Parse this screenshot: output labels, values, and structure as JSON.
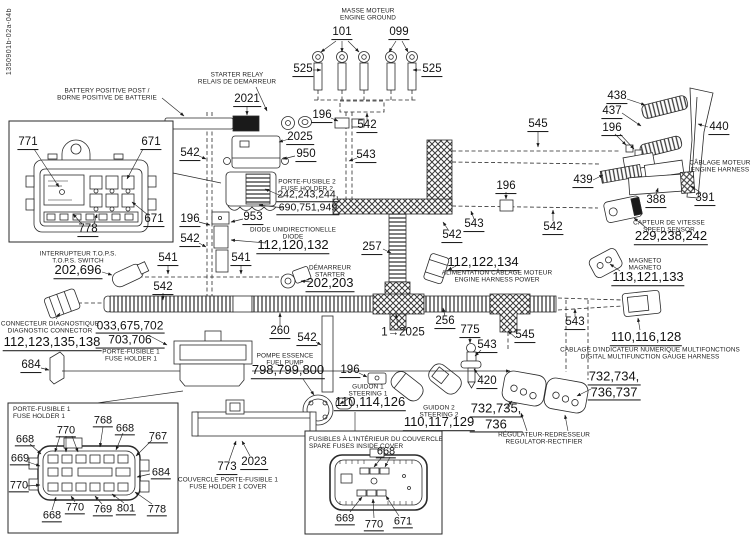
{
  "drawing_number": "1350901b-02a-04b",
  "colors": {
    "ink": "#1a1a1a",
    "paper": "#ffffff"
  },
  "callouts": [
    {
      "t": "101",
      "x": 342,
      "y": 33
    },
    {
      "t": "099",
      "x": 399,
      "y": 33
    },
    {
      "t": "525",
      "x": 303,
      "y": 70
    },
    {
      "t": "525",
      "x": 432,
      "y": 70
    },
    {
      "t": "2021",
      "x": 247,
      "y": 100
    },
    {
      "t": "196",
      "x": 322,
      "y": 116
    },
    {
      "t": "542",
      "x": 367,
      "y": 126
    },
    {
      "t": "2025",
      "x": 300,
      "y": 138
    },
    {
      "t": "950",
      "x": 306,
      "y": 155
    },
    {
      "t": "543",
      "x": 366,
      "y": 156
    },
    {
      "t": "542",
      "x": 190,
      "y": 154
    },
    {
      "t": "242,243,244,\n690,751,949",
      "x": 308,
      "y": 202,
      "s": 10.5
    },
    {
      "t": "196",
      "x": 190,
      "y": 220
    },
    {
      "t": "953",
      "x": 253,
      "y": 218
    },
    {
      "t": "112,120,132",
      "x": 293,
      "y": 246,
      "s": 13
    },
    {
      "t": "542",
      "x": 190,
      "y": 240
    },
    {
      "t": "541",
      "x": 168,
      "y": 259
    },
    {
      "t": "541",
      "x": 241,
      "y": 259
    },
    {
      "t": "542",
      "x": 163,
      "y": 288
    },
    {
      "t": "202,696",
      "x": 78,
      "y": 271,
      "s": 13
    },
    {
      "t": "112,123,135,138",
      "x": 52,
      "y": 343,
      "s": 13
    },
    {
      "t": "033,675,702\n703,706",
      "x": 130,
      "y": 334,
      "s": 12
    },
    {
      "t": "684",
      "x": 31,
      "y": 366
    },
    {
      "t": "202,203",
      "x": 330,
      "y": 284,
      "s": 13
    },
    {
      "t": "257",
      "x": 372,
      "y": 248
    },
    {
      "t": "543",
      "x": 474,
      "y": 225
    },
    {
      "t": "542",
      "x": 452,
      "y": 236
    },
    {
      "t": "112,122,134",
      "x": 483,
      "y": 263,
      "s": 13
    },
    {
      "t": "545",
      "x": 538,
      "y": 125
    },
    {
      "t": "438",
      "x": 617,
      "y": 97
    },
    {
      "t": "437",
      "x": 612,
      "y": 112
    },
    {
      "t": "196",
      "x": 612,
      "y": 129
    },
    {
      "t": "440",
      "x": 719,
      "y": 128
    },
    {
      "t": "439",
      "x": 583,
      "y": 181
    },
    {
      "t": "388",
      "x": 656,
      "y": 201
    },
    {
      "t": "391",
      "x": 705,
      "y": 199
    },
    {
      "t": "196",
      "x": 506,
      "y": 187
    },
    {
      "t": "542",
      "x": 553,
      "y": 228
    },
    {
      "t": "229,238,242",
      "x": 671,
      "y": 237,
      "s": 13
    },
    {
      "t": "113,121,133",
      "x": 648,
      "y": 278,
      "s": 13
    },
    {
      "t": "543",
      "x": 575,
      "y": 323
    },
    {
      "t": "110,116,128",
      "x": 646,
      "y": 338,
      "s": 13
    },
    {
      "t": "256",
      "x": 445,
      "y": 322
    },
    {
      "t": "1→2025",
      "x": 403,
      "y": 333,
      "u": false
    },
    {
      "t": "260",
      "x": 280,
      "y": 332
    },
    {
      "t": "542",
      "x": 307,
      "y": 339
    },
    {
      "t": "196",
      "x": 350,
      "y": 371
    },
    {
      "t": "798,799,800",
      "x": 288,
      "y": 371,
      "s": 13
    },
    {
      "t": "110,114,126",
      "x": 370,
      "y": 403,
      "s": 13
    },
    {
      "t": "775",
      "x": 470,
      "y": 331
    },
    {
      "t": "543",
      "x": 487,
      "y": 346
    },
    {
      "t": "545",
      "x": 525,
      "y": 336
    },
    {
      "t": "420",
      "x": 487,
      "y": 382
    },
    {
      "t": "110,117,129",
      "x": 439,
      "y": 423,
      "s": 13
    },
    {
      "t": "732,735,\n736",
      "x": 496,
      "y": 417,
      "s": 13
    },
    {
      "t": "732,734,\n736,737",
      "x": 614,
      "y": 385,
      "s": 13
    },
    {
      "t": "773",
      "x": 227,
      "y": 468
    },
    {
      "t": "2023",
      "x": 254,
      "y": 463
    },
    {
      "t": "771",
      "x": 28,
      "y": 143
    },
    {
      "t": "671",
      "x": 151,
      "y": 143
    },
    {
      "t": "671",
      "x": 154,
      "y": 220
    },
    {
      "t": "778",
      "x": 88,
      "y": 230
    },
    {
      "t": "768",
      "x": 103,
      "y": 421,
      "s": 11
    },
    {
      "t": "668",
      "x": 125,
      "y": 429,
      "s": 11
    },
    {
      "t": "767",
      "x": 158,
      "y": 437,
      "s": 11
    },
    {
      "t": "770",
      "x": 66,
      "y": 431,
      "s": 11
    },
    {
      "t": "668",
      "x": 25,
      "y": 440,
      "s": 11
    },
    {
      "t": "669",
      "x": 20,
      "y": 459,
      "s": 11
    },
    {
      "t": "684",
      "x": 161,
      "y": 473,
      "s": 11
    },
    {
      "t": "770",
      "x": 19,
      "y": 486,
      "s": 11
    },
    {
      "t": "668",
      "x": 52,
      "y": 516,
      "s": 11
    },
    {
      "t": "770",
      "x": 75,
      "y": 508,
      "s": 11
    },
    {
      "t": "769",
      "x": 103,
      "y": 510,
      "s": 11
    },
    {
      "t": "801",
      "x": 126,
      "y": 509,
      "s": 11
    },
    {
      "t": "778",
      "x": 157,
      "y": 510,
      "s": 11
    },
    {
      "t": "668",
      "x": 386,
      "y": 452,
      "s": 11
    },
    {
      "t": "669",
      "x": 345,
      "y": 519,
      "s": 11
    },
    {
      "t": "770",
      "x": 374,
      "y": 525,
      "s": 11
    },
    {
      "t": "671",
      "x": 403,
      "y": 522,
      "s": 11
    }
  ],
  "captions": [
    {
      "t": "MASSE MOTEUR\nENGINE GROUND",
      "x": 368,
      "y": 15
    },
    {
      "t": "STARTER RELAY\nRELAIS DE DEMARREUR",
      "x": 237,
      "y": 79
    },
    {
      "t": "BATTERY POSITIVE POST /\nBORNE POSITIVE DE BATTERIE",
      "x": 107,
      "y": 95
    },
    {
      "t": "PORTE-FUSIBLE 2\nFUSE HOLDER 2",
      "x": 307,
      "y": 186
    },
    {
      "t": "DIODE UNIDIRECTIONELLE\nDIODE",
      "x": 293,
      "y": 234
    },
    {
      "t": "DÉMARREUR\nSTARTER",
      "x": 330,
      "y": 272
    },
    {
      "t": "INTERRUPTEUR T.O.P.S.\nT.O.P.S. SWITCH",
      "x": 78,
      "y": 258
    },
    {
      "t": "CONNECTEUR DIAGNOSTIQUE\nDIAGNOSTIC CONNECTOR",
      "x": 50,
      "y": 328
    },
    {
      "t": "PORTE-FUSIBLE 1\nFUSE HOLDER 1",
      "x": 131,
      "y": 356
    },
    {
      "t": "POMPE ESSENCE\nFUEL PUMP",
      "x": 285,
      "y": 360
    },
    {
      "t": "COUVERCLE PORTE-FUSIBLE 1\nFUSE HOLDER 1 COVER",
      "x": 228,
      "y": 484
    },
    {
      "t": "GUIDON 1\nSTEERING 1",
      "x": 368,
      "y": 391
    },
    {
      "t": "GUIDON 2\nSTEERING 2",
      "x": 439,
      "y": 412
    },
    {
      "t": "RÉGULATEUR-REDRESSEUR\nREGULATOR-RECTIFIER",
      "x": 544,
      "y": 439
    },
    {
      "t": "ALIMENTATION CÂBLAGE MOTEUR\nENGINE HARNESS POWER",
      "x": 497,
      "y": 277
    },
    {
      "t": "CÂBLAGE MOTEUR\nENGINE HARNESS",
      "x": 720,
      "y": 167
    },
    {
      "t": "CAPTEUR DE VITESSE\nSPEED SENSOR",
      "x": 669,
      "y": 227
    },
    {
      "t": "MAGNETO\nMAGNETO",
      "x": 645,
      "y": 265
    },
    {
      "t": "CABLAGE D'INDICATEUR NUMERIQUE MULTIFONCTIONS\nDIGITAL MULTIFUNCTION GAUGE HARNESS",
      "x": 650,
      "y": 354
    },
    {
      "t": "PORTE-FUSIBLE 1\nFUSE HOLDER 1",
      "x": 13,
      "y": 406,
      "a": "left"
    },
    {
      "t": "FUSIBLES À L'INTÉRIEUR DU COUVERCLE\nSPARE FUSES INSIDE COVER",
      "x": 309,
      "y": 436,
      "a": "left"
    }
  ]
}
